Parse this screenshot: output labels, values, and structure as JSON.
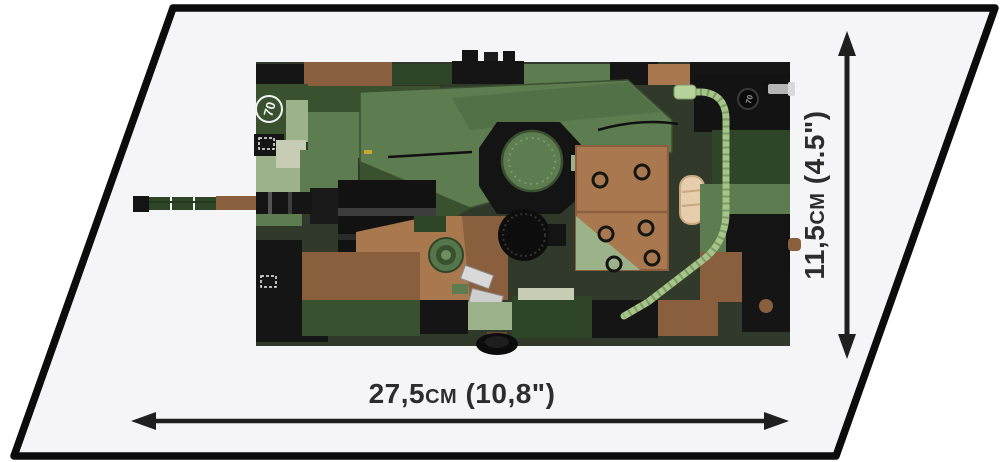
{
  "dimensions": {
    "width_label": "27,5cm (10,8\")",
    "height_label": "11,5cm (4.5\")"
  },
  "model": {
    "roundel_text": "70",
    "badge_text": "70"
  },
  "colors": {
    "background": "#ffffff",
    "platform_fill": "#f5f5f7",
    "platform_border": "#0c0c0c",
    "arrow": "#1f1f1f",
    "label_text": "#2d2d2d",
    "camo_green": "#5d7d51",
    "camo_dark_green": "#3a5130",
    "camo_deep_green": "#2f4527",
    "camo_sage": "#9cb38a",
    "camo_pale_sage": "#c6cdb4",
    "camo_brown": "#a9784e",
    "camo_dark_brown": "#8a5f3d",
    "brick_black": "#141414",
    "hose_green": "#a6c689",
    "tarp_tan": "#e6cdab"
  }
}
